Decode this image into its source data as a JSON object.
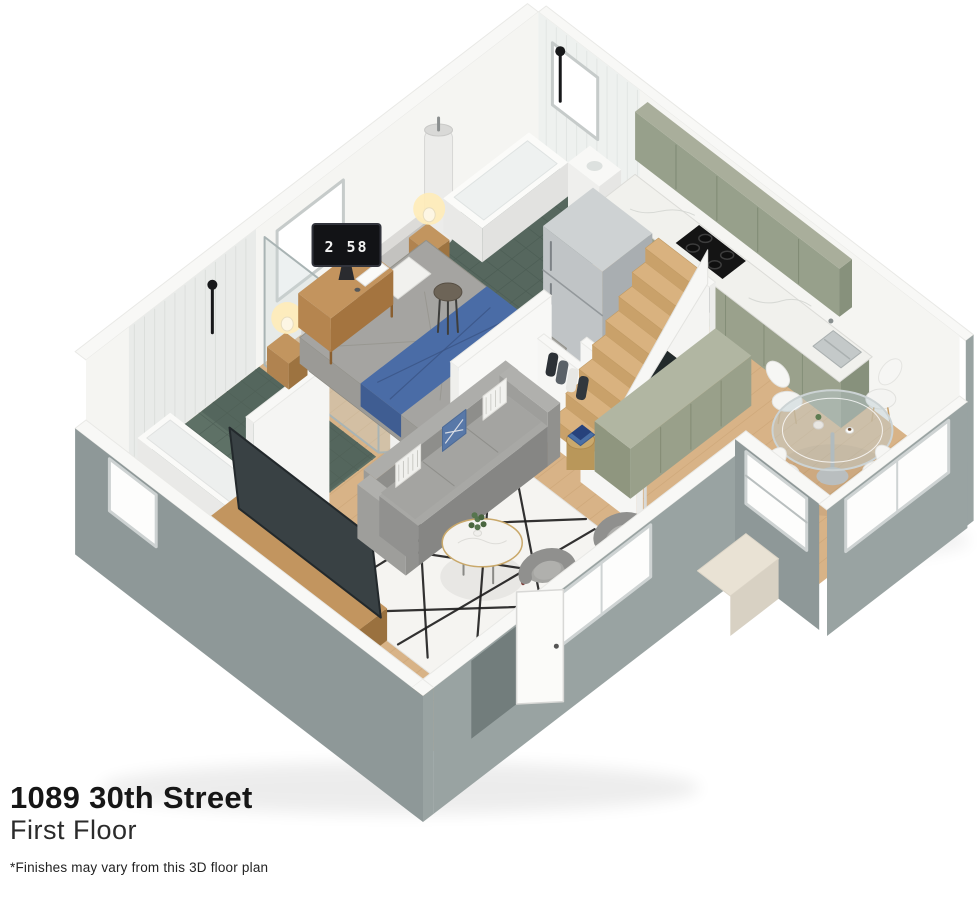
{
  "annotation": {
    "address": "1089 30th Street",
    "floor": "First Floor",
    "disclaimer": "*Finishes may vary from this 3D floor plan"
  },
  "scene": {
    "clock_time": "2 58",
    "rooms": [
      "living-room",
      "bedroom",
      "kitchen",
      "dining-area",
      "bathroom-main",
      "bathroom-ensuite",
      "hallway",
      "staircase"
    ],
    "objects": [
      "sofa",
      "armchairs",
      "coffee-table",
      "area-rug",
      "tv",
      "media-console",
      "side-table",
      "bed",
      "nightstands",
      "table-lamps",
      "desk",
      "desk-monitor-flip-clock",
      "stool",
      "staircase",
      "sideboard-cabinet",
      "coat-rack",
      "refrigerator",
      "cooktop",
      "oven",
      "kitchen-sink",
      "kitchen-cabinets",
      "marble-countertop",
      "dining-table",
      "dining-chairs",
      "bathtub",
      "walk-in-shower",
      "toilets",
      "bathroom-sinks",
      "water-heater",
      "windows",
      "doors"
    ]
  },
  "colors": {
    "background": "#ffffff",
    "wood_floor": "#d8b387",
    "wood_plank_line": "#c8a173",
    "cabinet_sage": "#9aa18c",
    "cabinet_sage_dark": "#87917c",
    "cabinet_sage_top": "#a9ae9b",
    "countertop_marble": "#f1f1ed",
    "wall_top": "#f8f8f6",
    "wall_interior": "#f5f5f2",
    "wall_exterior": "#8e9898",
    "wall_exterior_alt": "#99a3a2",
    "bathroom_tile": "#5e7166",
    "bathroom_tile_dark": "#56675e",
    "blanket_blue": "#4a6ca6",
    "stair_wood": "#d9b27f",
    "text_color": "#161616"
  }
}
